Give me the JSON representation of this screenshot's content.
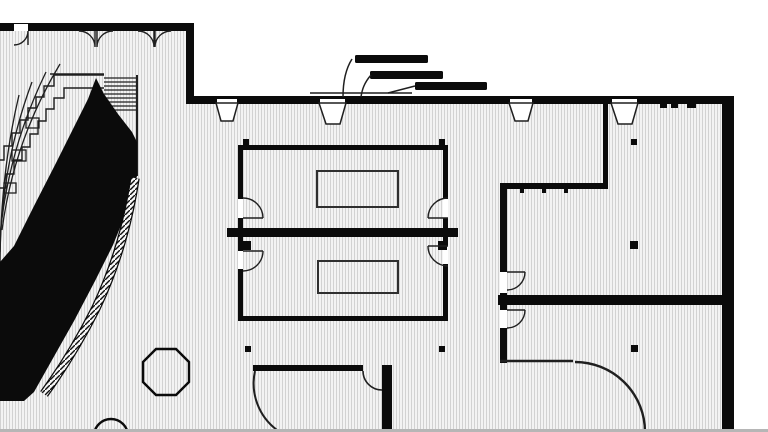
{
  "drawing": {
    "type": "architectural-floor-plan",
    "width": 768,
    "height": 432
  },
  "colors": {
    "wall": "#0b0b0b",
    "line": "#1f1f1f",
    "white": "#ffffff",
    "gray": "#b6b6b6",
    "table": "#2f2f2f",
    "floorBase": "#f3f3f3",
    "floorLine": "#d2d2d2"
  },
  "plan": {
    "elements": [
      {
        "t": "rect",
        "n": "floor-area",
        "x": 0,
        "y": 23,
        "w": 734,
        "h": 406,
        "f": "floorpat"
      },
      {
        "t": "rect",
        "n": "outside-top-mask",
        "x": 0,
        "y": 0,
        "w": 768,
        "h": 23,
        "f": "white"
      },
      {
        "t": "rect",
        "n": "outside-upper-right-mask",
        "x": 194,
        "y": 0,
        "w": 574,
        "h": 96,
        "f": "white"
      },
      {
        "t": "rect",
        "n": "outside-right-mask",
        "x": 734,
        "y": 0,
        "w": 34,
        "h": 432,
        "f": "white"
      },
      {
        "t": "path",
        "n": "amphitheater-row-1",
        "d": "M60,64 Q14,140 2,230",
        "s": "line",
        "sw": 1.3,
        "f": "none"
      },
      {
        "t": "path",
        "n": "amphitheater-row-2",
        "d": "M46,72 Q8,150 0,236",
        "s": "line",
        "sw": 1.3,
        "f": "none"
      },
      {
        "t": "path",
        "n": "amphitheater-row-3",
        "d": "M32,82 Q2,162 0,252",
        "s": "line",
        "sw": 1.3,
        "f": "none"
      },
      {
        "t": "path",
        "n": "amphitheater-row-4",
        "d": "M19,95 Q0,175 0,268",
        "s": "line",
        "sw": 1.3,
        "f": "none"
      },
      {
        "t": "path",
        "n": "amphitheater-step-band-outer",
        "d": "M104,75 H54 V86 H44 V97 H36 V108 H28 V120 H20 V133 H12 V146 H4 V160 H0",
        "s": "line",
        "sw": 1.4,
        "f": "none"
      },
      {
        "t": "path",
        "n": "amphitheater-step-band-inner",
        "d": "M104,88 H64 V98 H54 V109 H46 V121 H38 V134 H30 V147 H22 V160 H14 V174 H6 V188 H0",
        "s": "line",
        "sw": 1.4,
        "f": "none"
      },
      {
        "t": "rect",
        "n": "seating-tier-block-1",
        "x": 26,
        "y": 118,
        "w": 13,
        "h": 10,
        "s": "line",
        "sw": 1.3,
        "f": "none"
      },
      {
        "t": "rect",
        "n": "seating-tier-block-2",
        "x": 12,
        "y": 150,
        "w": 14,
        "h": 11,
        "s": "line",
        "sw": 1.3,
        "f": "none"
      },
      {
        "t": "rect",
        "n": "seating-tier-block-3",
        "x": 4,
        "y": 183,
        "w": 12,
        "h": 10,
        "s": "line",
        "sw": 1.3,
        "f": "none"
      },
      {
        "t": "path",
        "n": "stair-top-edge",
        "d": "M50,74 H104",
        "s": "line",
        "sw": 1.4,
        "f": "none"
      },
      {
        "t": "line",
        "n": "stair-tread",
        "x1": 104,
        "y1": 78,
        "x2": 137,
        "y2": 78,
        "s": "line",
        "sw": 1.2
      },
      {
        "t": "line",
        "n": "stair-tread",
        "x1": 104,
        "y1": 82,
        "x2": 137,
        "y2": 82,
        "s": "line",
        "sw": 1.2
      },
      {
        "t": "line",
        "n": "stair-tread",
        "x1": 104,
        "y1": 86,
        "x2": 137,
        "y2": 86,
        "s": "line",
        "sw": 1.2
      },
      {
        "t": "line",
        "n": "stair-tread",
        "x1": 104,
        "y1": 90,
        "x2": 137,
        "y2": 90,
        "s": "line",
        "sw": 1.2
      },
      {
        "t": "line",
        "n": "stair-tread",
        "x1": 104,
        "y1": 94,
        "x2": 137,
        "y2": 94,
        "s": "line",
        "sw": 1.2
      },
      {
        "t": "line",
        "n": "stair-tread",
        "x1": 104,
        "y1": 98,
        "x2": 137,
        "y2": 98,
        "s": "line",
        "sw": 1.2
      },
      {
        "t": "line",
        "n": "stair-tread",
        "x1": 104,
        "y1": 102,
        "x2": 137,
        "y2": 102,
        "s": "line",
        "sw": 1.2
      },
      {
        "t": "line",
        "n": "stair-tread",
        "x1": 104,
        "y1": 106,
        "x2": 137,
        "y2": 106,
        "s": "line",
        "sw": 1.2
      },
      {
        "t": "line",
        "n": "stair-tread",
        "x1": 104,
        "y1": 110,
        "x2": 137,
        "y2": 110,
        "s": "line",
        "sw": 1.2
      },
      {
        "t": "line",
        "n": "stair-right-edge",
        "x1": 137,
        "y1": 75,
        "x2": 137,
        "y2": 176,
        "s": "line",
        "sw": 2
      },
      {
        "t": "path",
        "n": "ramp-solid-mass",
        "d": "M96,78 L104,94 L118,114 L132,132 L137,142 L137,176 L128,208 L113,245 L95,281 L74,321 L52,360 L34,392 L24,401 L0,401 L0,262 L14,246 L34,206 L56,163 L74,127 L88,99 Z",
        "f": "wall"
      },
      {
        "t": "path",
        "n": "curved-wall-band-edge",
        "d": "M135,178 C128,225 114,270 96,308 C78,344 60,372 44,394",
        "s": "wall",
        "sw": 9.5,
        "f": "none"
      },
      {
        "t": "path",
        "n": "curved-wall-band-hatch",
        "d": "M135,178 C128,225 114,270 96,308 C78,344 60,372 44,394",
        "s": "bandpat",
        "sw": 7,
        "f": "none"
      },
      {
        "t": "rect",
        "n": "wall-top-left",
        "x": 0,
        "y": 23,
        "w": 193,
        "h": 8,
        "f": "wall"
      },
      {
        "t": "rect",
        "n": "wall-left-vertical",
        "x": 186,
        "y": 23,
        "w": 8,
        "h": 80,
        "f": "wall"
      },
      {
        "t": "rect",
        "n": "wall-top-main",
        "x": 186,
        "y": 96,
        "w": 548,
        "h": 8,
        "f": "wall"
      },
      {
        "t": "rect",
        "n": "wall-right-exterior",
        "x": 722,
        "y": 96,
        "w": 12,
        "h": 333,
        "f": "wall"
      },
      {
        "t": "rect",
        "n": "wall-middle-thick",
        "x": 227,
        "y": 228,
        "w": 231,
        "h": 9,
        "f": "wall"
      },
      {
        "t": "rect",
        "n": "room-a-wall-top",
        "x": 238,
        "y": 145,
        "w": 210,
        "h": 5,
        "f": "wall"
      },
      {
        "t": "rect",
        "n": "room-a-wall-left",
        "x": 238,
        "y": 145,
        "w": 5,
        "h": 83,
        "f": "wall"
      },
      {
        "t": "rect",
        "n": "room-a-wall-right",
        "x": 443,
        "y": 145,
        "w": 5,
        "h": 83,
        "f": "wall"
      },
      {
        "t": "rect",
        "n": "room-b-wall-left",
        "x": 238,
        "y": 237,
        "w": 5,
        "h": 84,
        "f": "wall"
      },
      {
        "t": "rect",
        "n": "room-b-wall-right",
        "x": 443,
        "y": 237,
        "w": 5,
        "h": 84,
        "f": "wall"
      },
      {
        "t": "rect",
        "n": "room-b-wall-bottom",
        "x": 238,
        "y": 316,
        "w": 210,
        "h": 5,
        "f": "wall"
      },
      {
        "t": "rect",
        "n": "right-room-wall-upper-vertical",
        "x": 603,
        "y": 100,
        "w": 5,
        "h": 88,
        "f": "wall"
      },
      {
        "t": "rect",
        "n": "right-room-wall-horizontal",
        "x": 500,
        "y": 183,
        "w": 108,
        "h": 6,
        "f": "wall"
      },
      {
        "t": "rect",
        "n": "right-room-wall-left-upper",
        "x": 500,
        "y": 183,
        "w": 7,
        "h": 122,
        "f": "wall"
      },
      {
        "t": "rect",
        "n": "right-room-wall-thick",
        "x": 498,
        "y": 295,
        "w": 236,
        "h": 10,
        "f": "wall"
      },
      {
        "t": "rect",
        "n": "right-room-wall-left-lower",
        "x": 500,
        "y": 305,
        "w": 7,
        "h": 58,
        "f": "wall"
      },
      {
        "t": "rect",
        "n": "bottom-room-wall-top",
        "x": 253,
        "y": 365,
        "w": 110,
        "h": 6,
        "f": "wall"
      },
      {
        "t": "rect",
        "n": "bottom-room-wall-right",
        "x": 382,
        "y": 365,
        "w": 10,
        "h": 64,
        "f": "wall"
      },
      {
        "t": "rect",
        "n": "door-gap-entry-left",
        "x": 14,
        "y": 24,
        "w": 14,
        "h": 7,
        "f": "white"
      },
      {
        "t": "rect",
        "n": "door-gap-main-1",
        "x": 217,
        "y": 99,
        "w": 20,
        "h": 5,
        "f": "white"
      },
      {
        "t": "rect",
        "n": "door-gap-main-2",
        "x": 320,
        "y": 99,
        "w": 25,
        "h": 5,
        "f": "white"
      },
      {
        "t": "rect",
        "n": "door-gap-main-3",
        "x": 510,
        "y": 99,
        "w": 22,
        "h": 5,
        "f": "white"
      },
      {
        "t": "rect",
        "n": "door-gap-main-4",
        "x": 612,
        "y": 99,
        "w": 25,
        "h": 5,
        "f": "white"
      },
      {
        "t": "rect",
        "n": "door-gap-room-a-left",
        "x": 238,
        "y": 199,
        "w": 5,
        "h": 19,
        "f": "white"
      },
      {
        "t": "rect",
        "n": "door-gap-room-a-right",
        "x": 443,
        "y": 199,
        "w": 5,
        "h": 19,
        "f": "white"
      },
      {
        "t": "rect",
        "n": "door-gap-room-b-left",
        "x": 238,
        "y": 251,
        "w": 5,
        "h": 18,
        "f": "white"
      },
      {
        "t": "rect",
        "n": "door-gap-room-b-right",
        "x": 443,
        "y": 246,
        "w": 5,
        "h": 18,
        "f": "white"
      },
      {
        "t": "rect",
        "n": "door-gap-right-room-upper",
        "x": 500,
        "y": 272,
        "w": 7,
        "h": 21,
        "f": "white"
      },
      {
        "t": "rect",
        "n": "door-gap-right-room-lower",
        "x": 500,
        "y": 310,
        "w": 7,
        "h": 18,
        "f": "white"
      },
      {
        "t": "rect",
        "n": "window-tick-1",
        "x": 660,
        "y": 103,
        "w": 7,
        "h": 5,
        "f": "wall"
      },
      {
        "t": "rect",
        "n": "window-tick-2",
        "x": 671,
        "y": 103,
        "w": 7,
        "h": 5,
        "f": "wall"
      },
      {
        "t": "rect",
        "n": "window-tick-3",
        "x": 687,
        "y": 103,
        "w": 9,
        "h": 5,
        "f": "wall"
      },
      {
        "t": "rect",
        "n": "window-tick-4",
        "x": 520,
        "y": 189,
        "w": 4,
        "h": 4,
        "f": "wall"
      },
      {
        "t": "rect",
        "n": "window-tick-5",
        "x": 542,
        "y": 189,
        "w": 4,
        "h": 4,
        "f": "wall"
      },
      {
        "t": "rect",
        "n": "window-tick-6",
        "x": 564,
        "y": 189,
        "w": 4,
        "h": 4,
        "f": "wall"
      },
      {
        "t": "rect",
        "n": "canopy-wall-band",
        "x": 372,
        "y": 100,
        "w": 40,
        "h": 4,
        "f": "wall"
      },
      {
        "t": "rect",
        "n": "column",
        "x": 243,
        "y": 139,
        "w": 6,
        "h": 6,
        "f": "wall"
      },
      {
        "t": "rect",
        "n": "column",
        "x": 439,
        "y": 139,
        "w": 6,
        "h": 6,
        "f": "wall"
      },
      {
        "t": "rect",
        "n": "column",
        "x": 242,
        "y": 241,
        "w": 9,
        "h": 9,
        "f": "wall"
      },
      {
        "t": "rect",
        "n": "column",
        "x": 438,
        "y": 241,
        "w": 9,
        "h": 9,
        "f": "wall"
      },
      {
        "t": "rect",
        "n": "column",
        "x": 245,
        "y": 346,
        "w": 6,
        "h": 6,
        "f": "wall"
      },
      {
        "t": "rect",
        "n": "column",
        "x": 439,
        "y": 346,
        "w": 6,
        "h": 6,
        "f": "wall"
      },
      {
        "t": "rect",
        "n": "column",
        "x": 631,
        "y": 139,
        "w": 6,
        "h": 6,
        "f": "wall"
      },
      {
        "t": "rect",
        "n": "column",
        "x": 630,
        "y": 241,
        "w": 8,
        "h": 8,
        "f": "wall"
      },
      {
        "t": "rect",
        "n": "column",
        "x": 631,
        "y": 345,
        "w": 7,
        "h": 7,
        "f": "wall"
      },
      {
        "t": "rect",
        "n": "column",
        "x": 51,
        "y": 344,
        "w": 5,
        "h": 5,
        "f": "wall"
      },
      {
        "t": "path",
        "n": "door-swing-entry-left",
        "d": "M28,31 A14,14 0 0 1 14,45 M28,31 L28,45",
        "s": "line",
        "sw": 1.4,
        "f": "none"
      },
      {
        "t": "path",
        "n": "door-swing-double-1-left",
        "d": "M79,31 A16,16 0 0 1 95,47 L95,31",
        "s": "line",
        "sw": 1.4,
        "f": "none"
      },
      {
        "t": "path",
        "n": "door-swing-double-1-right",
        "d": "M113,31 A16,16 0 0 0 97,47 L97,31",
        "s": "line",
        "sw": 1.4,
        "f": "none"
      },
      {
        "t": "path",
        "n": "door-swing-double-2-left",
        "d": "M138,31 A16,16 0 0 1 154,47 L154,31",
        "s": "line",
        "sw": 1.4,
        "f": "none"
      },
      {
        "t": "path",
        "n": "door-swing-double-2-right",
        "d": "M171,31 A16,16 0 0 0 155,47 L155,31",
        "s": "line",
        "sw": 1.4,
        "f": "none"
      },
      {
        "t": "path",
        "n": "door-swing-room-a-left",
        "d": "M263,218 A20,20 0 0 0 243,198 M243,218 H263",
        "s": "line",
        "sw": 1.4,
        "f": "none"
      },
      {
        "t": "path",
        "n": "door-swing-room-a-right",
        "d": "M428,218 A20,20 0 0 1 448,198 M428,218 H448",
        "s": "line",
        "sw": 1.4,
        "f": "none"
      },
      {
        "t": "path",
        "n": "door-swing-room-b-left",
        "d": "M263,251 A20,20 0 0 1 243,271 M243,251 H263",
        "s": "line",
        "sw": 1.4,
        "f": "none"
      },
      {
        "t": "path",
        "n": "door-swing-room-b-right",
        "d": "M428,246 A20,20 0 0 0 448,266 M428,246 H448",
        "s": "line",
        "sw": 1.4,
        "f": "none"
      },
      {
        "t": "path",
        "n": "door-swing-right-room-upper",
        "d": "M525,272 A18,18 0 0 1 507,290 M507,272 H525",
        "s": "line",
        "sw": 1.4,
        "f": "none"
      },
      {
        "t": "path",
        "n": "door-swing-right-room-lower",
        "d": "M525,310 A18,18 0 0 1 507,328 M507,310 H525",
        "s": "line",
        "sw": 1.4,
        "f": "none"
      },
      {
        "t": "path",
        "n": "door-swing-bottom-room-corner",
        "d": "M363,371 A19,19 0 0 0 382,390",
        "s": "line",
        "sw": 1.6,
        "f": "none"
      },
      {
        "t": "path",
        "n": "door-swing-bottom-room-left",
        "d": "M255,371 A58,58 0 0 0 277,430",
        "s": "line",
        "sw": 2,
        "f": "none"
      },
      {
        "t": "path",
        "n": "door-swing-lower-right-arc",
        "d": "M575,362 A70,70 0 0 1 645,432",
        "s": "line",
        "sw": 2.4,
        "f": "none"
      },
      {
        "t": "path",
        "n": "door-leaf-lower-right",
        "d": "M500,361 H573",
        "s": "line",
        "sw": 2.4,
        "f": "none"
      },
      {
        "t": "rect",
        "n": "canopy-bar-1",
        "x": 355,
        "y": 55,
        "w": 73,
        "h": 8,
        "rx": 1.5,
        "f": "wall"
      },
      {
        "t": "rect",
        "n": "canopy-bar-2",
        "x": 370,
        "y": 71,
        "w": 73,
        "h": 8,
        "rx": 1.5,
        "f": "wall"
      },
      {
        "t": "rect",
        "n": "canopy-bar-3",
        "x": 415,
        "y": 82,
        "w": 72,
        "h": 8,
        "rx": 1.5,
        "f": "wall"
      },
      {
        "t": "path",
        "n": "canopy-support-1",
        "d": "M352,59 C345,70 343,83 343,97",
        "s": "line",
        "sw": 1.5,
        "f": "none"
      },
      {
        "t": "path",
        "n": "canopy-support-2",
        "d": "M371,75 C364,83 362,90 361,97",
        "s": "line",
        "sw": 1.5,
        "f": "none"
      },
      {
        "t": "path",
        "n": "canopy-support-3",
        "d": "M415,86 L388,93",
        "s": "line",
        "sw": 1.5,
        "f": "none"
      },
      {
        "t": "path",
        "n": "canopy-edge-line",
        "d": "M310,93 H412",
        "s": "line",
        "sw": 1.5,
        "f": "none"
      },
      {
        "t": "path",
        "n": "door-reveal-1",
        "d": "M216,103 H238 L233,121 H221 Z",
        "s": "line",
        "sw": 1.5,
        "f": "white"
      },
      {
        "t": "path",
        "n": "door-reveal-2",
        "d": "M319,103 H346 L340,124 H326 Z",
        "s": "line",
        "sw": 1.5,
        "f": "white"
      },
      {
        "t": "path",
        "n": "door-reveal-3",
        "d": "M509,103 H533 L528,121 H515 Z",
        "s": "line",
        "sw": 1.5,
        "f": "white"
      },
      {
        "t": "path",
        "n": "door-reveal-4",
        "d": "M611,103 H638 L632,124 H618 Z",
        "s": "line",
        "sw": 1.5,
        "f": "white"
      },
      {
        "t": "rect",
        "n": "table-room-a",
        "x": 317,
        "y": 171,
        "w": 81,
        "h": 36,
        "s": "table",
        "sw": 2,
        "f": "none"
      },
      {
        "t": "rect",
        "n": "table-room-b",
        "x": 318,
        "y": 261,
        "w": 80,
        "h": 32,
        "s": "table",
        "sw": 2,
        "f": "none"
      },
      {
        "t": "polygon",
        "n": "octagon-feature",
        "pts": "189,362 176,349 156,349 143,362 143,382 156,395 176,395 189,382",
        "s": "wall",
        "sw": 2.4,
        "f": "none"
      },
      {
        "t": "circle",
        "n": "round-feature",
        "cx": 111,
        "cy": 436,
        "r": 17,
        "s": "wall",
        "sw": 2.4,
        "f": "none"
      },
      {
        "t": "rect",
        "n": "bottom-gray-strip",
        "x": 0,
        "y": 429,
        "w": 768,
        "h": 3,
        "f": "gray"
      }
    ]
  }
}
